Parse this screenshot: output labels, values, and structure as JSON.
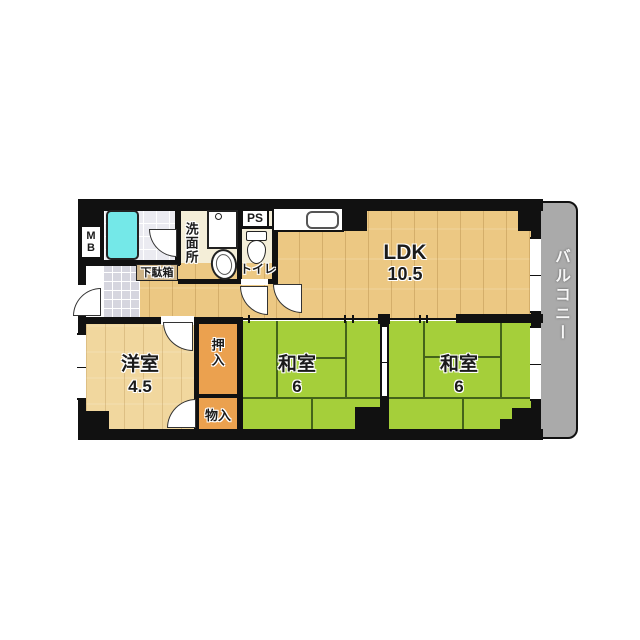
{
  "title": "2LDK apartment floor plan",
  "rooms": {
    "ldk": {
      "name": "LDK",
      "area": "10.5"
    },
    "washitsu_left": {
      "name": "和室",
      "area": "6"
    },
    "washitsu_right": {
      "name": "和室",
      "area": "6"
    },
    "youshitsu": {
      "name": "洋室",
      "area": "4.5"
    },
    "balcony": {
      "name": "バルコニー"
    },
    "washroom": {
      "name": "洗面所"
    },
    "toilet": {
      "name": "トイレ"
    },
    "oshiire": {
      "name": "押入"
    },
    "monoire": {
      "name": "物入"
    },
    "getabako": {
      "name": "下駄箱"
    },
    "meter_box": {
      "name": "MB"
    },
    "pipe_space": {
      "name": "PS"
    }
  },
  "colors": {
    "wall": "#111111",
    "wood": "#ecc883",
    "wood_light": "#f1d79e",
    "tatami": "#a5cf3a",
    "tatami_line": "#44641a",
    "closet": "#eba14f",
    "cream": "#f4eed8",
    "bath_cyan": "#74e8e8",
    "balcony_gray": "#aaaaaa",
    "getabako_tan": "#cdb387"
  }
}
